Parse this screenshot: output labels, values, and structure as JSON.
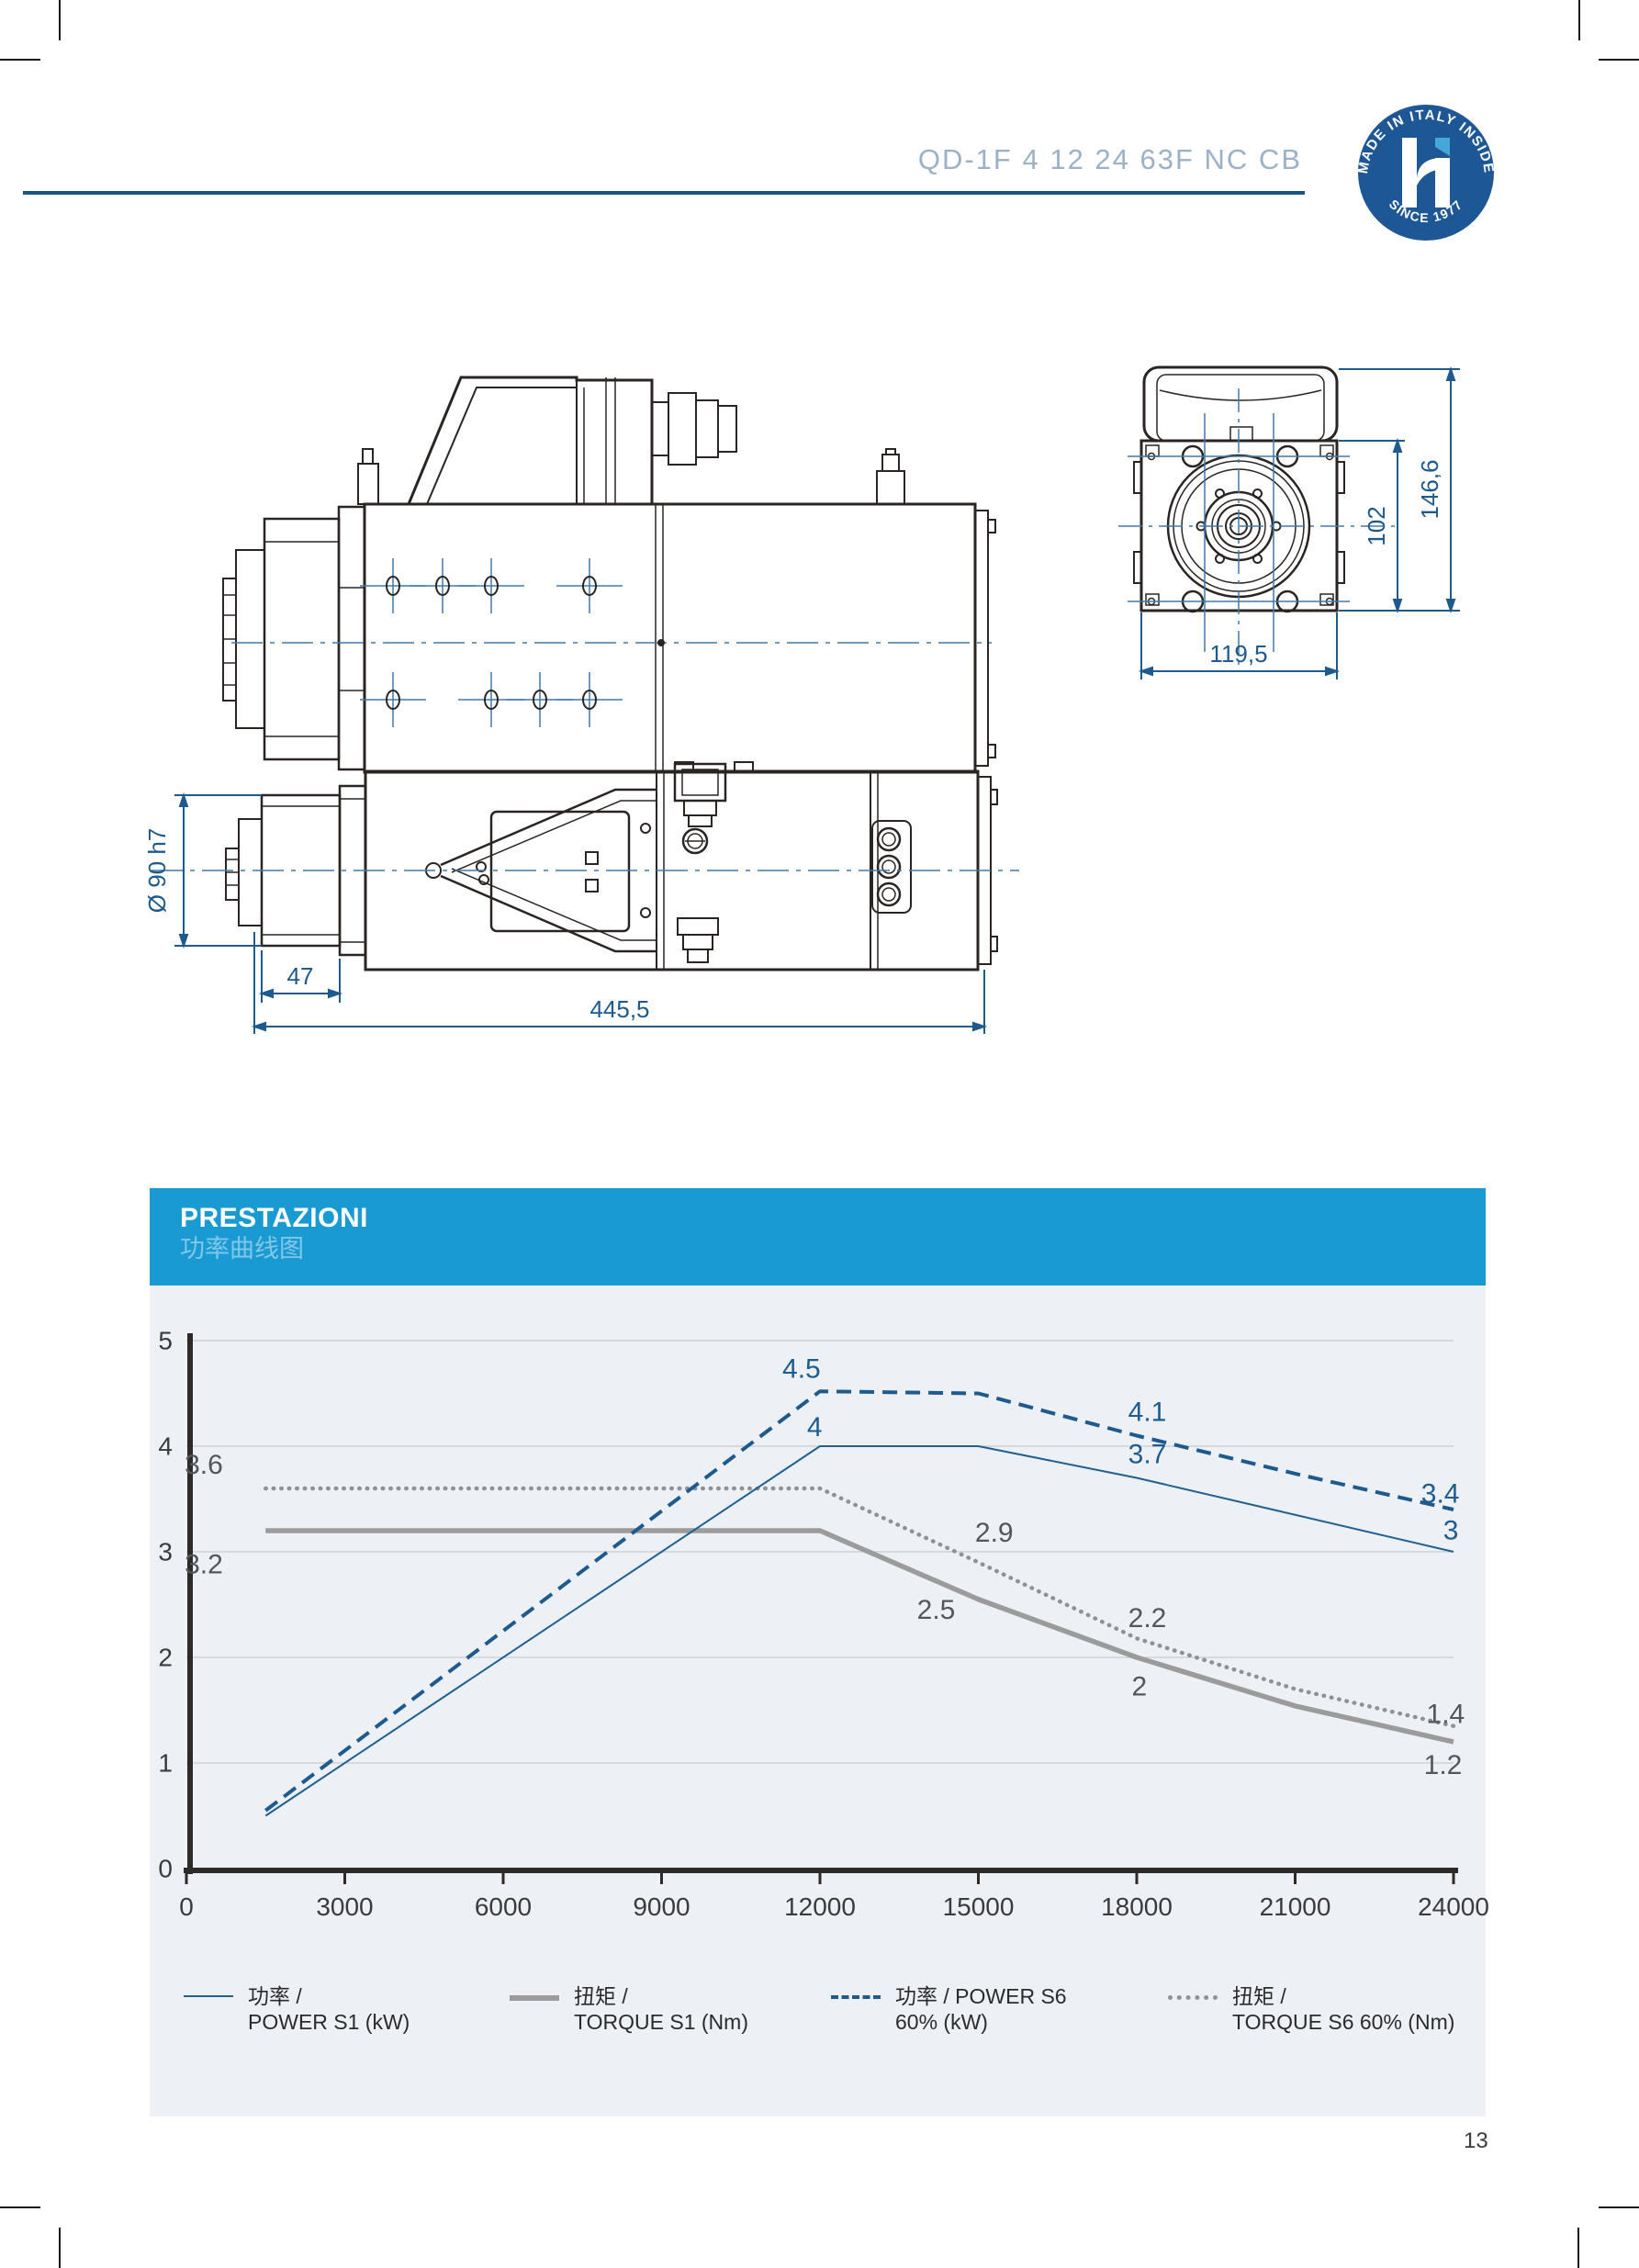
{
  "page": {
    "number": "13"
  },
  "header": {
    "product_code": "QD-1F 4 12 24 63F NC CB",
    "badge": {
      "arc_top": "MADE IN ITALY INSIDE",
      "arc_bottom": "SINCE 1977"
    }
  },
  "drawings": {
    "front_view": {
      "overall_height": "146,6",
      "flange_height": "102",
      "body_width": "119,5"
    },
    "top_view": {
      "shaft_diameter": "Ø 90 h7",
      "nose_length": "47",
      "overall_length": "445,5"
    }
  },
  "performance": {
    "title": "PRESTAZIONI",
    "subtitle": "功率曲线图",
    "legend": [
      {
        "swatch": "thin-blue-line",
        "line1": "功率 /",
        "line2": "POWER S1 (kW)"
      },
      {
        "swatch": "thick-gray-line",
        "line1": "扭矩 /",
        "line2": "TORQUE S1 (Nm)"
      },
      {
        "swatch": "dashed-blue-line",
        "line1": "功率 / POWER S6",
        "line2": "60% (kW)"
      },
      {
        "swatch": "dotted-gray-line",
        "line1": "扭矩 /",
        "line2": "TORQUE S6 60% (Nm)"
      }
    ]
  },
  "chart_data": {
    "type": "line",
    "title": "PRESTAZIONI / 功率曲线图",
    "xlim": [
      0,
      24000
    ],
    "ylim": [
      0,
      5
    ],
    "x_ticks": [
      0,
      3000,
      6000,
      9000,
      12000,
      15000,
      18000,
      21000,
      24000
    ],
    "y_ticks": [
      0,
      1,
      2,
      3,
      4,
      5
    ],
    "grid": true,
    "legend_position": "bottom",
    "x": [
      1500,
      12000,
      15000,
      18000,
      21000,
      24000
    ],
    "series": [
      {
        "name": "POWER S1 (kW)",
        "style": "power-s1",
        "color": "#21608f",
        "values": [
          0.5,
          4,
          4,
          3.7,
          3.35,
          3
        ]
      },
      {
        "name": "POWER S6 60% (kW)",
        "style": "power-s6",
        "color": "#1e5a8d",
        "values": [
          0.55,
          4.52,
          4.5,
          4.1,
          3.74,
          3.4
        ]
      },
      {
        "name": "TORQUE S1 (Nm)",
        "style": "torque-s1",
        "color": "#9b9b9b",
        "values": [
          3.2,
          3.2,
          2.55,
          2.0,
          1.54,
          1.2
        ]
      },
      {
        "name": "TORQUE S6 60% (Nm)",
        "style": "torque-s6",
        "color": "#8f9194",
        "values": [
          3.6,
          3.6,
          2.9,
          2.18,
          1.7,
          1.35
        ]
      }
    ],
    "point_labels": [
      {
        "text": "3.6",
        "x": 330,
        "y": 3.82,
        "series": "gray"
      },
      {
        "text": "3.2",
        "x": 330,
        "y": 2.88,
        "series": "gray"
      },
      {
        "text": "4.5",
        "x": 11650,
        "y": 4.73,
        "series": "blue"
      },
      {
        "text": "4",
        "x": 11900,
        "y": 4.18,
        "series": "blue"
      },
      {
        "text": "2.9",
        "x": 15300,
        "y": 3.18,
        "series": "gray"
      },
      {
        "text": "2.5",
        "x": 14200,
        "y": 2.45,
        "series": "gray"
      },
      {
        "text": "4.1",
        "x": 18200,
        "y": 4.32,
        "series": "blue"
      },
      {
        "text": "3.7",
        "x": 18200,
        "y": 3.92,
        "series": "blue"
      },
      {
        "text": "2.2",
        "x": 18200,
        "y": 2.37,
        "series": "gray"
      },
      {
        "text": "2",
        "x": 18050,
        "y": 1.72,
        "series": "gray"
      },
      {
        "text": "3.4",
        "x": 23750,
        "y": 3.55,
        "series": "blue"
      },
      {
        "text": "3",
        "x": 23950,
        "y": 3.2,
        "series": "blue"
      },
      {
        "text": "1.4",
        "x": 23850,
        "y": 1.46,
        "series": "gray"
      },
      {
        "text": "1.2",
        "x": 23800,
        "y": 0.98,
        "series": "gray"
      }
    ]
  }
}
